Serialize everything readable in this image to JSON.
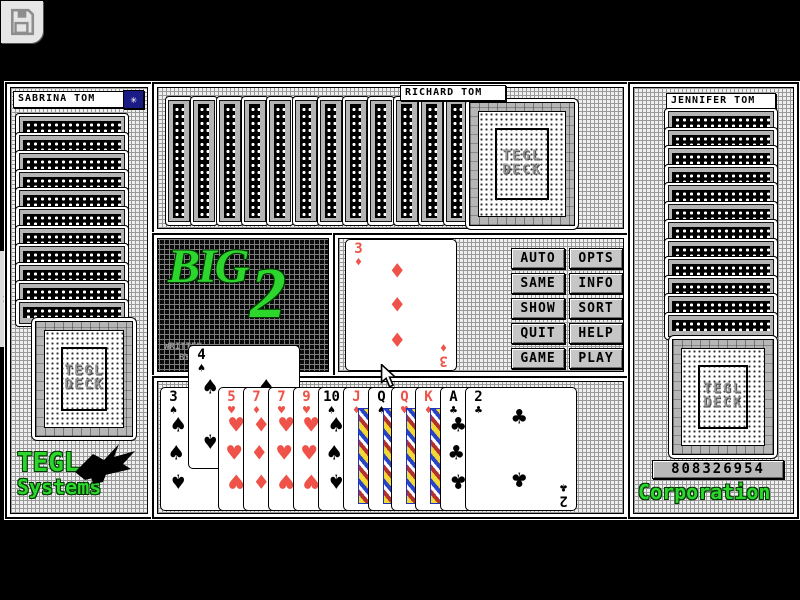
{
  "toolbar": {
    "save_icon": "floppy-disk"
  },
  "icons": {
    "tab_chevron": ">",
    "star": "✳"
  },
  "panels": {
    "left": {
      "title": "SABRINA TOM",
      "card_count": 11,
      "brand_line1": "TEGL",
      "brand_line2": "Systems"
    },
    "top": {
      "title": "RICHARD TOM",
      "card_count": 12
    },
    "right": {
      "title": "JENNIFER TOM",
      "card_count": 12,
      "score": "808326954",
      "brand": "Corporation"
    },
    "deck_label_line1": "TEGL",
    "deck_label_line2": "DECK"
  },
  "logo": {
    "big": "BIG",
    "two": "2",
    "credit_line1": "WRITTEN",
    "credit_line2": "BY"
  },
  "played_card": {
    "rank": "3",
    "suit": "♦",
    "color": "red"
  },
  "buttons": [
    {
      "label": "AUTO"
    },
    {
      "label": "OPTS"
    },
    {
      "label": "SAME"
    },
    {
      "label": "INFO"
    },
    {
      "label": "SHOW"
    },
    {
      "label": "SORT"
    },
    {
      "label": "QUIT"
    },
    {
      "label": "HELP"
    },
    {
      "label": "GAME"
    },
    {
      "label": "PLAY"
    }
  ],
  "hand": [
    {
      "rank": "3",
      "suit": "♠",
      "color": "black"
    },
    {
      "rank": "4",
      "suit": "♠",
      "color": "black",
      "raised": true
    },
    {
      "rank": "5",
      "suit": "♥",
      "color": "red"
    },
    {
      "rank": "7",
      "suit": "♦",
      "color": "red"
    },
    {
      "rank": "7",
      "suit": "♥",
      "color": "red"
    },
    {
      "rank": "9",
      "suit": "♥",
      "color": "red"
    },
    {
      "rank": "10",
      "suit": "♠",
      "color": "black"
    },
    {
      "rank": "J",
      "suit": "♦",
      "color": "red",
      "face": true
    },
    {
      "rank": "Q",
      "suit": "♠",
      "color": "black",
      "face": true
    },
    {
      "rank": "Q",
      "suit": "♥",
      "color": "red",
      "face": true
    },
    {
      "rank": "K",
      "suit": "♦",
      "color": "red",
      "face": true
    },
    {
      "rank": "A",
      "suit": "♣",
      "color": "black"
    },
    {
      "rank": "2",
      "suit": "♣",
      "color": "black",
      "full": true
    }
  ],
  "colors": {
    "suit_red": "#ee5248",
    "logo_green": "#2dd62d",
    "star_button_bg": "#1b1b85",
    "button_face": "#c6c6c6"
  }
}
